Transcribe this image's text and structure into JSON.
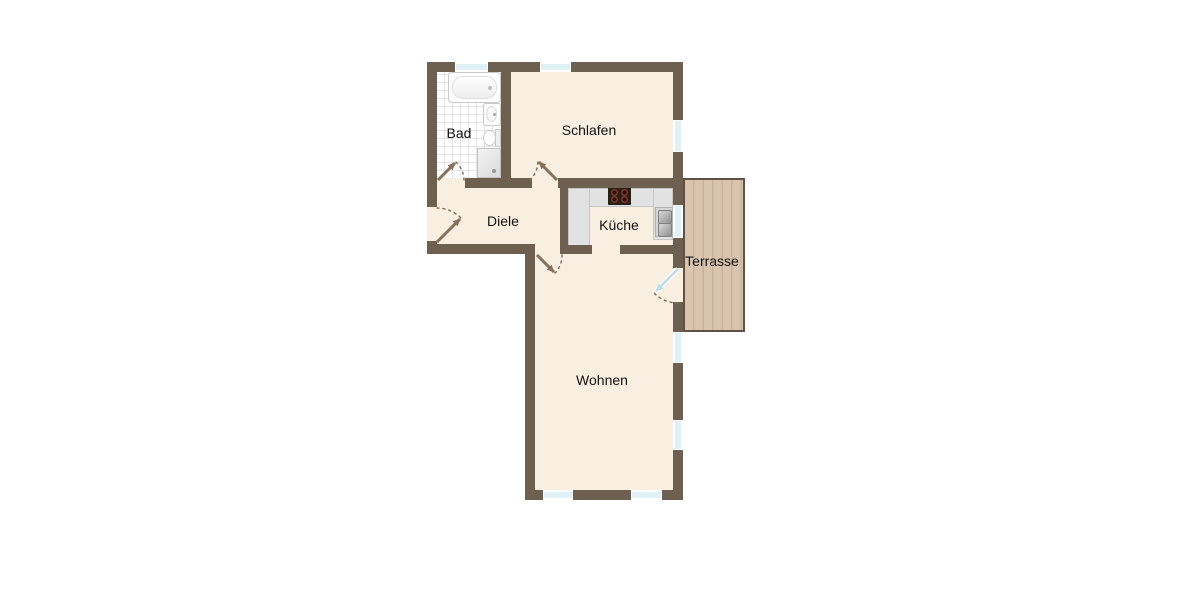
{
  "rooms": {
    "bad": {
      "label": "Bad"
    },
    "schlafen": {
      "label": "Schlafen"
    },
    "diele": {
      "label": "Diele"
    },
    "kueche": {
      "label": "Küche"
    },
    "terrasse": {
      "label": "Terrasse"
    },
    "wohnen": {
      "label": "Wohnen"
    }
  },
  "fixtures": [
    "bathtub-icon",
    "washbasin-icon",
    "toilet-icon",
    "shower-icon",
    "stove-icon",
    "kitchen-sink-icon",
    "kitchen-counter",
    "door-swing-icon",
    "window-icon",
    "terrace-decking"
  ],
  "openings": {
    "window_count": 8,
    "door_count": 5
  },
  "colors": {
    "background": "#ffffff",
    "wall": "#6e6050",
    "floor": "#f9efe0",
    "tile_line": "#e4e4e4",
    "window_glass": "#dff0f6",
    "terrace_wood": "#d9c4ae",
    "terrace_plank_line": "#c9b29a",
    "terrace_border": "#5f5244",
    "counter": "#e2e2e2",
    "counter_edge": "#c6c6c6",
    "stove": "#2b1f15",
    "burner": "#7e3c2e",
    "door_swing": "#86715a",
    "glass_door": "#b9dde9",
    "fixture_outline": "#c9c9c9",
    "label": "#111111"
  }
}
